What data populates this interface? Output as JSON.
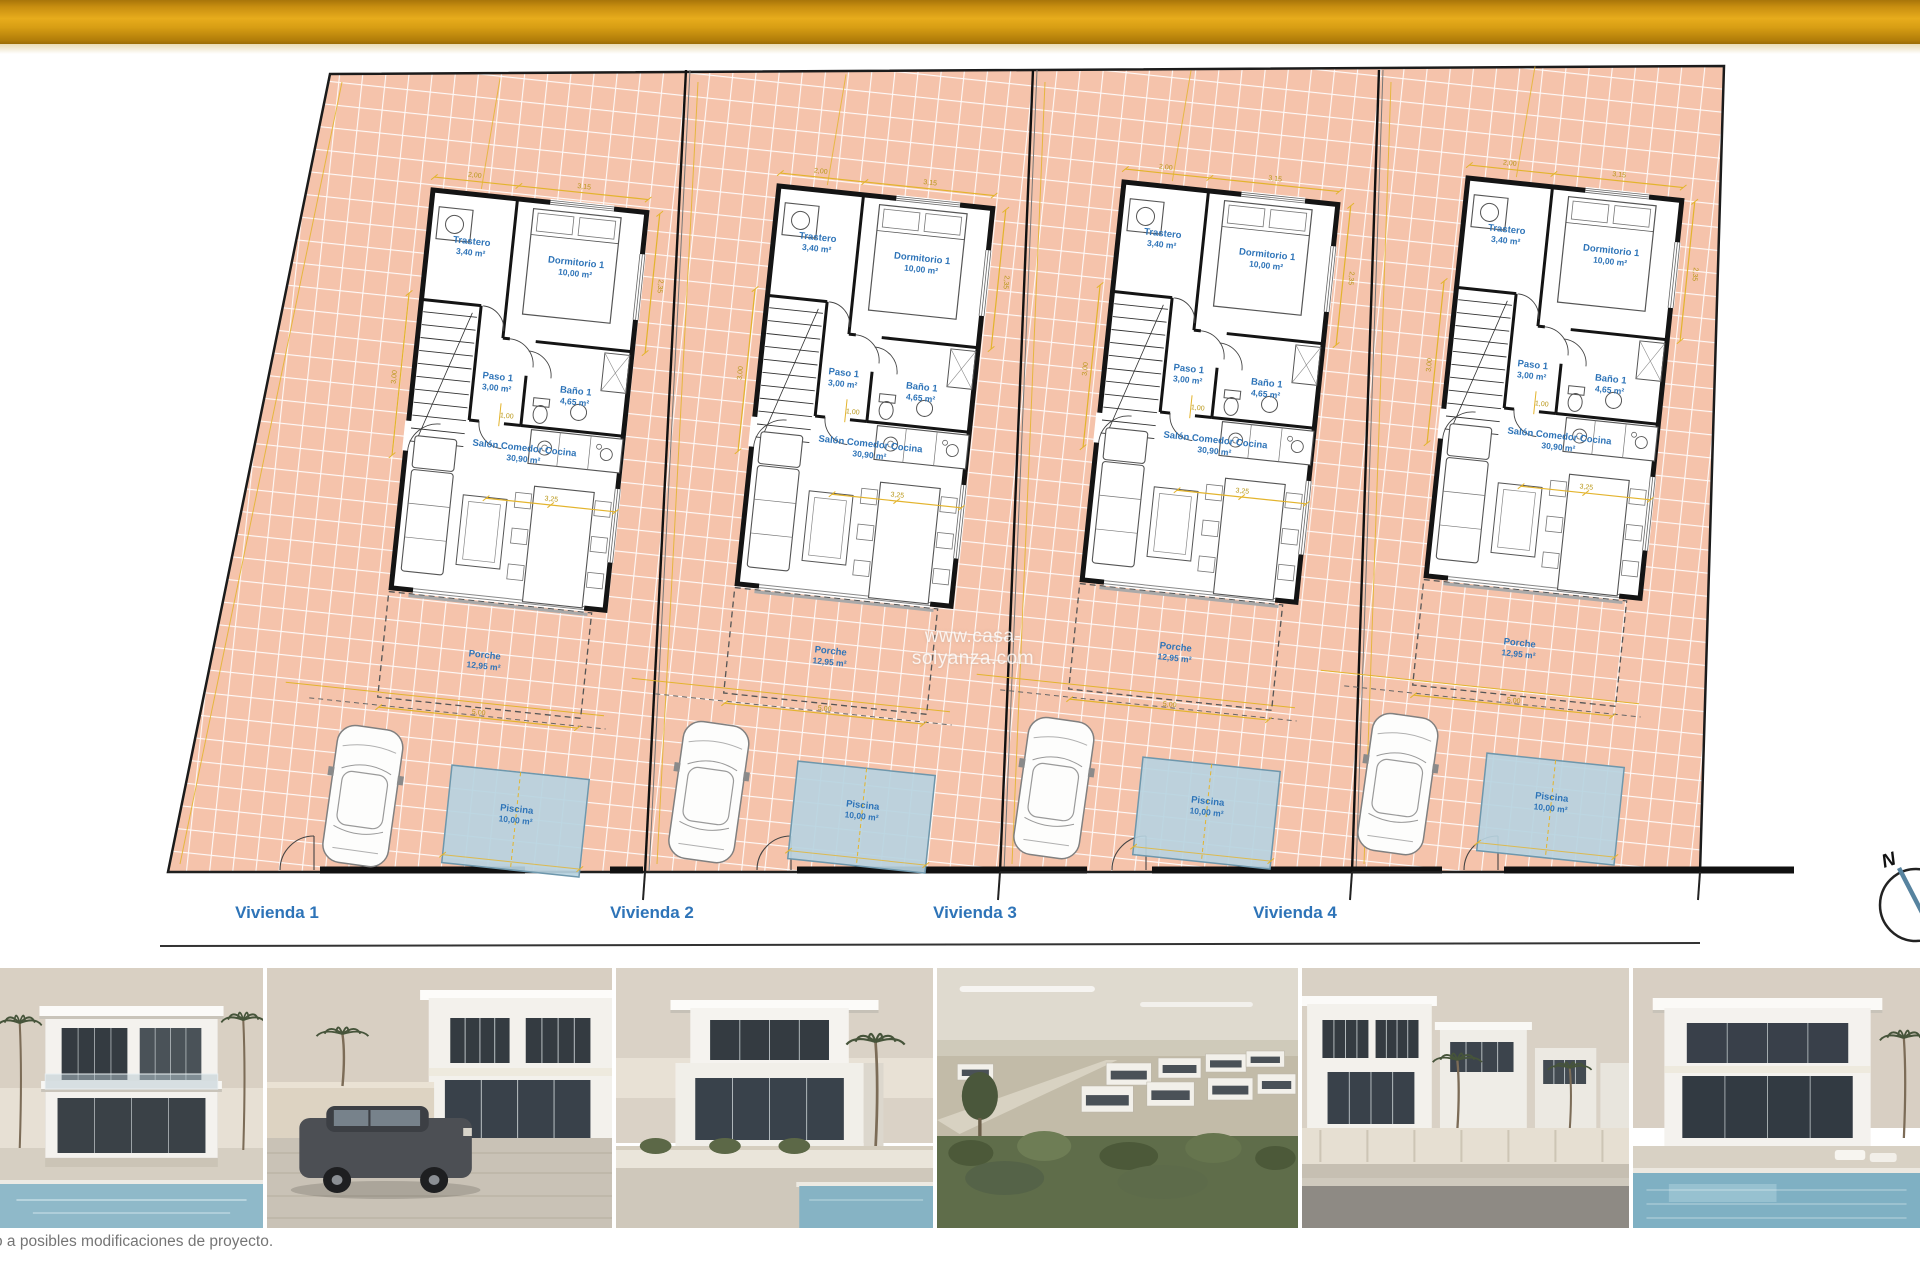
{
  "header": {
    "title": "Planta General",
    "accent_gold": "#d89e14"
  },
  "plan": {
    "watermark": "www.casa-solyanza.com",
    "compass_label": "N",
    "viviendas": [
      "Vivienda 1",
      "Vivienda 2",
      "Vivienda 3",
      "Vivienda 4"
    ],
    "rooms": [
      {
        "name": "Trastero",
        "area": "3,40 m²"
      },
      {
        "name": "Dormitorio 1",
        "area": "10,00 m²"
      },
      {
        "name": "Paso 1",
        "area": "3,00 m²"
      },
      {
        "name": "Baño 1",
        "area": "4,65 m²"
      },
      {
        "name": "Salón Comedor Cocina",
        "area": "30,90 m²"
      },
      {
        "name": "Porche",
        "area": "12,95 m²"
      },
      {
        "name": "Piscina",
        "area": "10,00 m²"
      }
    ],
    "dims": [
      "3,15",
      "2,00",
      "1,00",
      "3,25",
      "5,00",
      "2,35",
      "3,00"
    ],
    "colors": {
      "tile": "#f5c3ab",
      "label_blue": "#2e74b8",
      "pool": "#b7d2e0",
      "dim_yellow": "#e3b42d",
      "dim_text": "#b99718",
      "wall": "#141414"
    }
  },
  "photos": {
    "items": [
      {
        "name": "render-villa-front-pool"
      },
      {
        "name": "render-villa-with-car"
      },
      {
        "name": "render-villa-corner-palm"
      },
      {
        "name": "render-aerial-development"
      },
      {
        "name": "render-street-row"
      },
      {
        "name": "render-villa-terrace-pool"
      }
    ]
  },
  "footer": {
    "disclaimer": "o a posibles modificaciones de proyecto."
  }
}
